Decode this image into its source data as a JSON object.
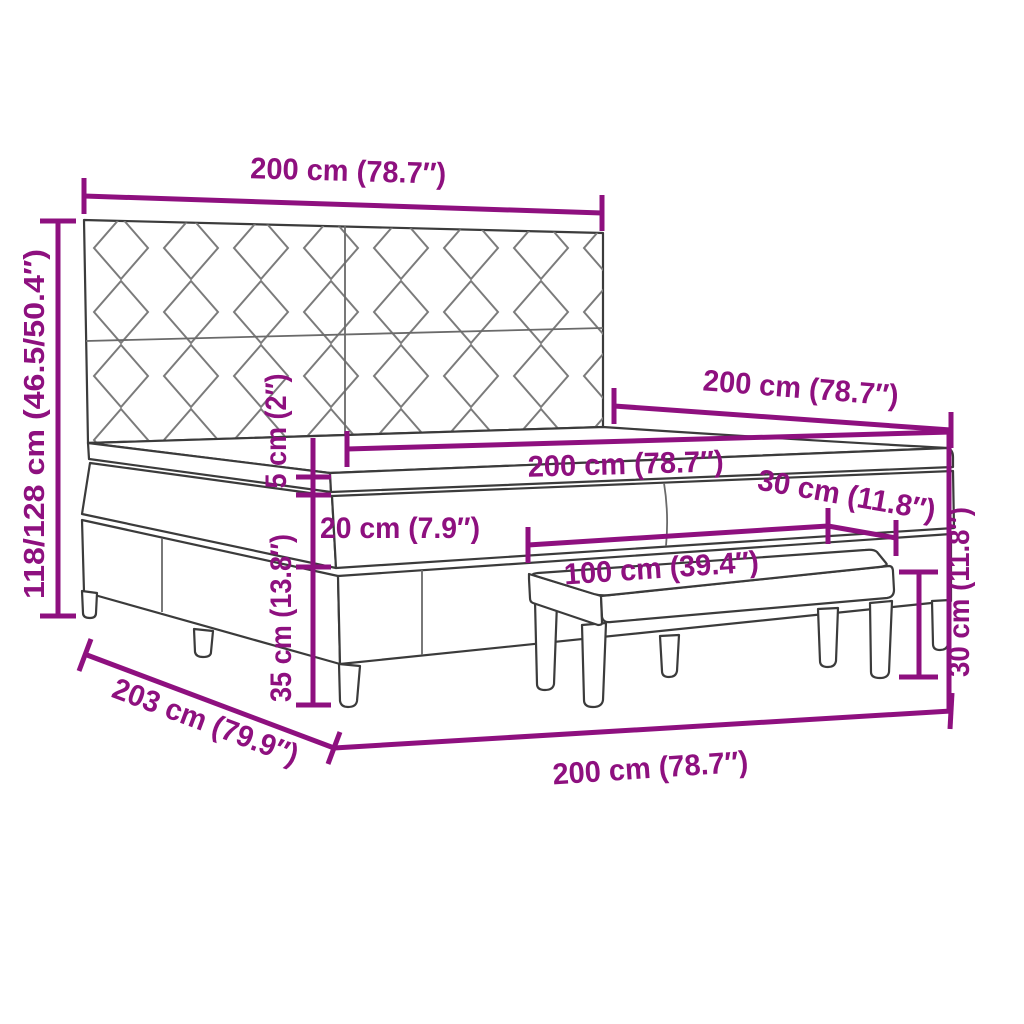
{
  "figure": {
    "type": "product-dimension-diagram",
    "product": "Box spring bed with patterned headboard and bench",
    "background": "#ffffff",
    "colors": {
      "dimension_lines": "#8E107F",
      "drawing_outline": "#3b3b3b",
      "upholstery_pattern": "#7b7b7b"
    },
    "labels": {
      "headboard_width": "200 cm (78.7″)",
      "overall_height": "118/128 cm (46.5/50.4″)",
      "bed_side_length": "200 cm (78.7″)",
      "mattress_width": "200 cm (78.7″)",
      "topper_thickness": "5 cm (2″)",
      "mattress_thickness": "20 cm (7.9″)",
      "base_height": "35 cm (13.8″)",
      "overall_length": "203 cm (79.9″)",
      "bed_front_width": "200 cm (78.7″)",
      "bench_length": "100 cm (39.4″)",
      "bench_depth": "30 cm (11.8″)",
      "bench_height": "30 cm (11.8″)"
    }
  }
}
